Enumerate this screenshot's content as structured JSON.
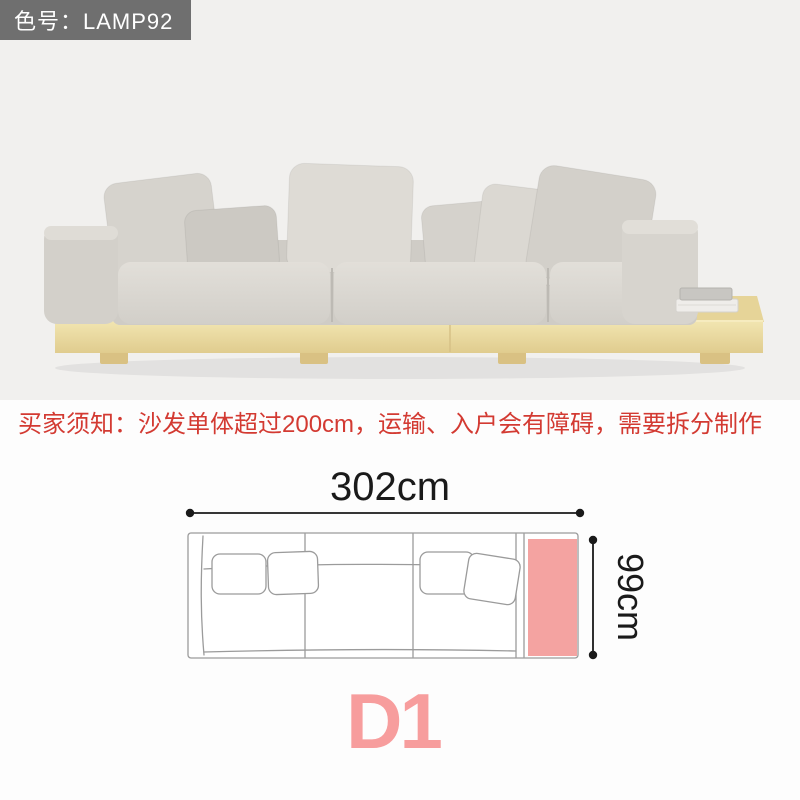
{
  "badge": {
    "label": "色号：LAMP92"
  },
  "notice": {
    "text": "买家须知：沙发单体超过200cm，运输、入户会有障碍，需要拆分制作"
  },
  "diagram": {
    "width_label": "302cm",
    "depth_label": "99cm",
    "variant_label": "D1"
  },
  "photo": {
    "description": "Light grey three-seat platform sofa with seven loose cushions on a pale wood plinth base; the plinth extends right as a side table holding a small stack of books"
  },
  "colors": {
    "photo_background": "#f1f0ee",
    "badge_background": "#6f6f6f",
    "badge_text": "#ffffff",
    "notice_red": "#d33a32",
    "diagram_pink_block": "#f4a3a1",
    "variant_pink": "#f79d9d",
    "dimension_line": "#1a1a1a",
    "sketch_stroke": "#9b9b9b",
    "sofa_fabric": "#d8d5cf",
    "wood_base": "#e8d79f"
  }
}
